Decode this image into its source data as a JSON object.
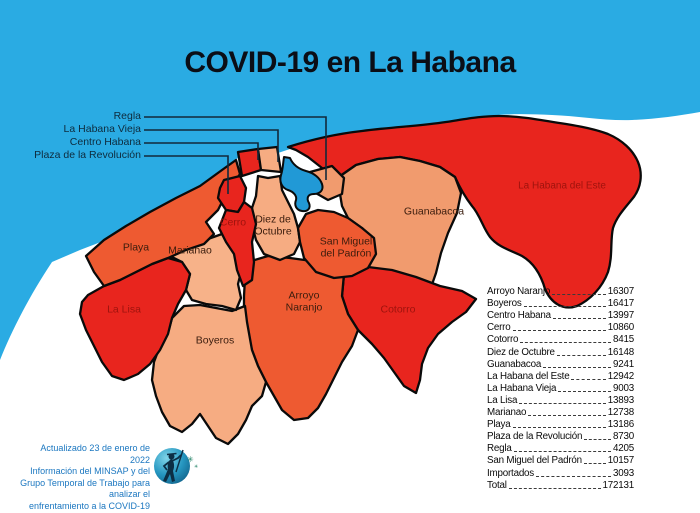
{
  "title": "COVID-19 en La Habana",
  "callouts": [
    "Regla",
    "La Habana Vieja",
    "Centro Habana",
    "Plaza de la Revolución"
  ],
  "map_labels": {
    "playa": "Playa",
    "la_lisa": "La Lisa",
    "marianao": "Marianao",
    "cerro": "Cerro",
    "diez_de_octubre": "Diez de\nOctubre",
    "boyeros": "Boyeros",
    "arroyo_naranjo": "Arroyo\nNaranjo",
    "san_miguel_del_padron": "San Miguel\ndel Padrón",
    "guanabacoa": "Guanabacoa",
    "cotorro": "Cotorro",
    "la_habana_del_este": "La Habana del Este"
  },
  "stats": {
    "rows": [
      {
        "name": "Arroyo Naranjo",
        "value": "16307"
      },
      {
        "name": "Boyeros",
        "value": "16417"
      },
      {
        "name": "Centro Habana",
        "value": "13997"
      },
      {
        "name": "Cerro",
        "value": "10860"
      },
      {
        "name": "Cotorro",
        "value": "8415"
      },
      {
        "name": "Diez de Octubre",
        "value": "16148"
      },
      {
        "name": "Guanabacoa",
        "value": "9241"
      },
      {
        "name": "La Habana del Este",
        "value": "12942"
      },
      {
        "name": "La Habana Vieja",
        "value": "9003"
      },
      {
        "name": "La Lisa",
        "value": "13893"
      },
      {
        "name": "Marianao",
        "value": "12738"
      },
      {
        "name": "Playa",
        "value": "13186"
      },
      {
        "name": "Plaza de la Revolución",
        "value": "8730"
      },
      {
        "name": "Regla",
        "value": "4205"
      },
      {
        "name": "San Miguel del Padrón",
        "value": "10157"
      },
      {
        "name": "Importados",
        "value": "3093"
      },
      {
        "name": "Total",
        "value": "172131"
      }
    ]
  },
  "credit": {
    "lines": [
      "Actualizado 23 de enero de 2022",
      "Información del MINSAP y del",
      "Grupo Temporal de Trabajo para analizar el",
      "enfrentamiento a la COVID-19 en La Habana"
    ]
  },
  "icons": {
    "sparkle": "✳"
  },
  "colors": {
    "sea": "#2aabe3",
    "bay": "#2199d6",
    "red": "#e8251e",
    "orange": "#ee5a31",
    "peach_light": "#f6ac82",
    "peach": "#f19b6e",
    "dark_red_label": "#9e130d",
    "credit_blue": "#1b77c0",
    "title": "#0b0e16"
  }
}
